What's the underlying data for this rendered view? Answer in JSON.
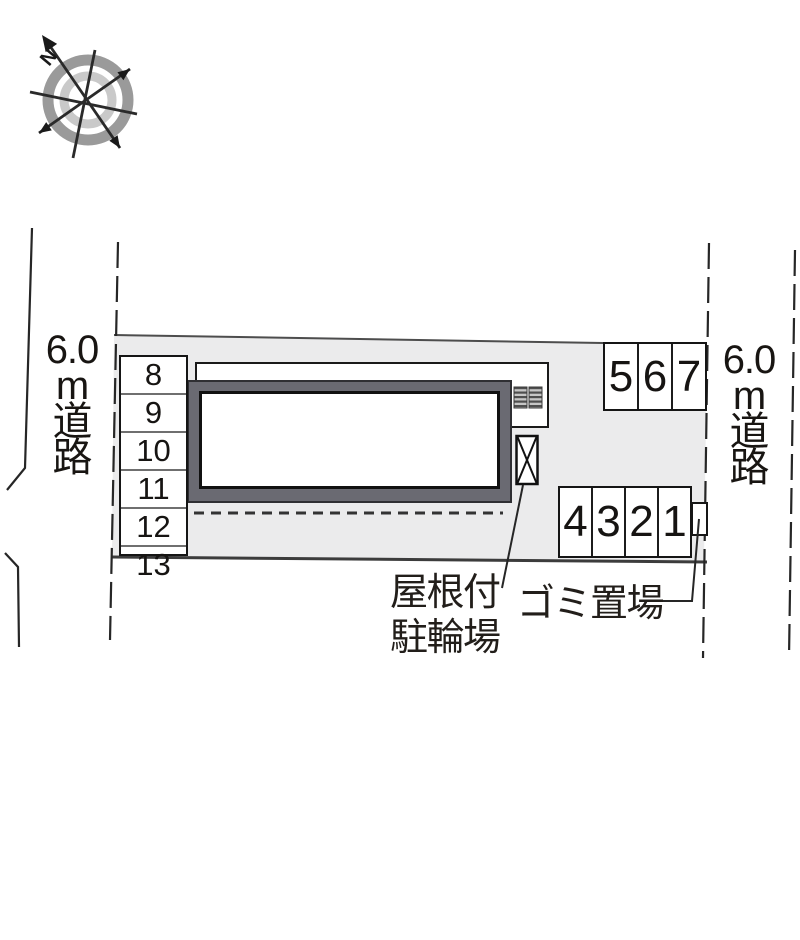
{
  "compass": {
    "north_label": "N"
  },
  "roads": {
    "left": {
      "label_lines": [
        "6.0",
        "m",
        "道",
        "路"
      ]
    },
    "right": {
      "label_lines": [
        "6.0",
        "m",
        "道",
        "路"
      ]
    }
  },
  "parking": {
    "left_column_stalls": [
      "8",
      "9",
      "10",
      "11",
      "12",
      "13"
    ],
    "top_right_stalls": [
      "5",
      "6",
      "7"
    ],
    "bottom_right_stalls": [
      "4",
      "3",
      "2",
      "1"
    ]
  },
  "annotations": {
    "covered_bicycle_parking_lines": [
      "屋根付",
      "駐輪場"
    ],
    "garbage_area": "ゴミ置場"
  },
  "colors": {
    "site_fill": "#ebebec",
    "building_wall": "#6a6a72",
    "line_dark": "#262626",
    "boundary_gray": "#4d4d4d",
    "compass_ring_outer": "#9a9a9a",
    "compass_ring_inner": "#c9c9c9"
  }
}
